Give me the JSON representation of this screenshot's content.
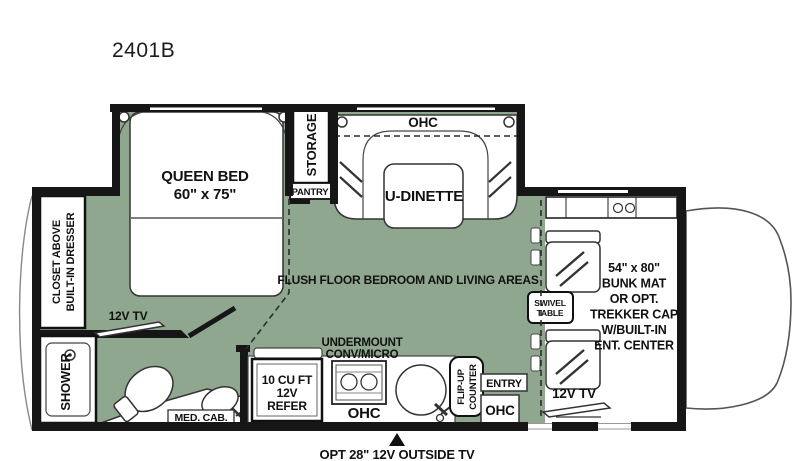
{
  "title": "2401B",
  "colors": {
    "floor": "#8EA78E",
    "wall": "#161616",
    "outline": "#333333"
  },
  "bedroom": {
    "bed_line1": "QUEEN BED",
    "bed_line2": "60\" x 75\"",
    "storage": "STORAGE",
    "pantry": "PANTRY",
    "closet_line1": "CLOSET ABOVE",
    "closet_line2": "BUILT-IN DRESSER",
    "tv": "12V TV"
  },
  "bathroom": {
    "shower": "SHOWER",
    "med_cab": "MED. CAB."
  },
  "dinette": {
    "ohc": "OHC",
    "name": "U-DINETTE"
  },
  "kitchen": {
    "undermount_line1": "UNDERMOUNT",
    "undermount_line2": "CONV/MICRO",
    "refer_line1": "10 CU FT",
    "refer_line2": "12V",
    "refer_line3": "REFER",
    "ohc": "OHC"
  },
  "entry": {
    "flip_line1": "FLIP-UP",
    "flip_line2": "COUNTER",
    "entry": "ENTRY",
    "ohc": "OHC"
  },
  "living": {
    "flush_floor": "FLUSH FLOOR BEDROOM AND LIVING AREAS",
    "tv": "12V TV",
    "swivel_line1": "SWIVEL",
    "swivel_line2": "TABLE"
  },
  "cab": {
    "bunk_line1": "54\" x 80\"",
    "bunk_line2": "BUNK MAT",
    "bunk_line3": "OR OPT.",
    "bunk_line4": "TREKKER CAP",
    "bunk_line5": "W/BUILT-IN",
    "bunk_line6": "ENT. CENTER"
  },
  "footer": {
    "outside_tv": "OPT 28\" 12V OUTSIDE TV"
  }
}
